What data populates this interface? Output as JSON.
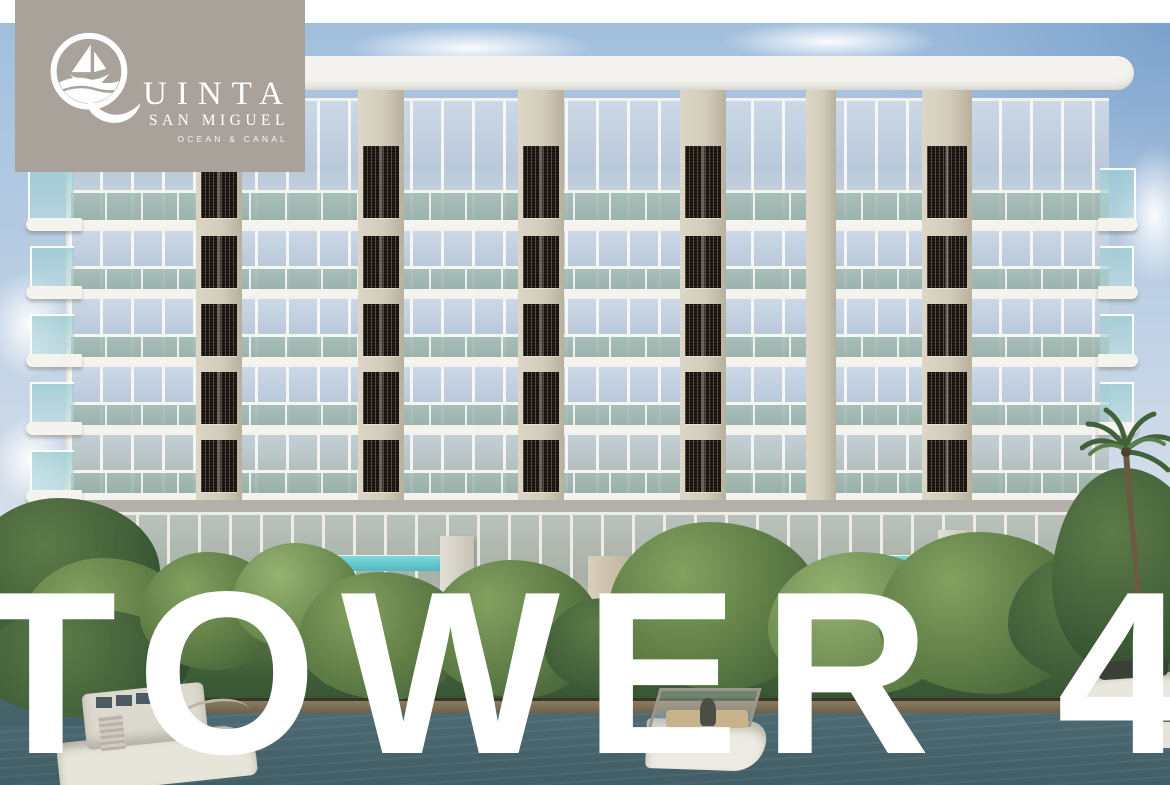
{
  "brand": {
    "initial": "Q",
    "name_rest": "UINTA",
    "name_full": "QUINTA",
    "subtitle": "SAN MIGUEL",
    "tagline": "OCEAN & CANAL"
  },
  "hero": {
    "title": "TOWER 4"
  },
  "scene": {
    "subject": "six-story condominium facade on a canal with boats, trees and palms",
    "floors_visible": 6
  },
  "palette": {
    "logo_bg": "#a9a29b",
    "logo_text": "#ffffff",
    "title_text": "#ffffff",
    "facade_cream": "#d3ccba",
    "slab_white": "#f3f2ed",
    "lattice_dark": "#211b15",
    "sky_blue": "#a9c6e2",
    "water_teal": "#44616a",
    "foliage_green": "#5b7a44",
    "pool_turquoise": "#62c8cd",
    "ground_gray": "#b3b0a9"
  }
}
